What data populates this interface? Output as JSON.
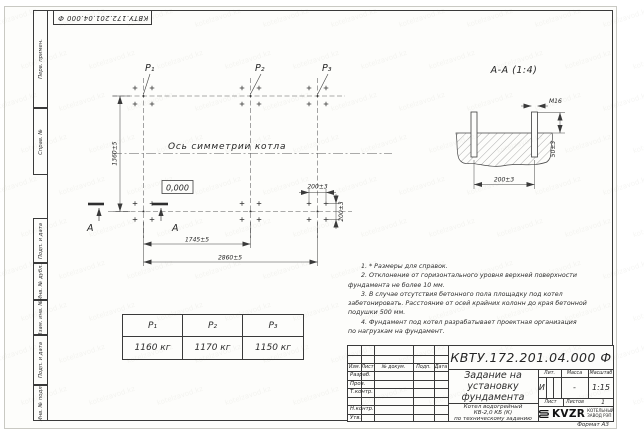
{
  "sheet": {
    "stamp_top_left": "КВТУ.172.201.04.000 Ф",
    "format_label": "Формат А3",
    "margin_fields": [
      "Перв. примен.",
      "Справ. №",
      "Подп. и дата",
      "Инв. № дубл.",
      "Взам. инв. №",
      "Подп. и дата",
      "Инв. № подл."
    ]
  },
  "watermark": {
    "text": "kotelzavod.kz"
  },
  "plan": {
    "load_labels": [
      "P₁",
      "P₂",
      "P₃"
    ],
    "axis_label": "Ось симметрии котла",
    "elevation": "0,000",
    "section_letter": "А",
    "dims": {
      "height": "1360±5",
      "span1": "1745±5",
      "span2": "2860±5",
      "bolt_h": "200±3",
      "bolt_v": "200±3"
    }
  },
  "section": {
    "title": "А-А (1:4)",
    "bolt_label": "М16",
    "dim_protrusion": "50±3",
    "dim_spacing": "200±3"
  },
  "loads_table": {
    "headers": [
      "P₁",
      "P₂",
      "P₃"
    ],
    "values": [
      "1160 кг",
      "1170 кг",
      "1150 кг"
    ]
  },
  "notes": {
    "lines": [
      "1. * Размеры для справок.",
      "2. Отклонение от горизонтального уровня верхней поверхности",
      "фундамента не более 10 мм.",
      "3. В случае отсутствия бетонного пола площадку под котел",
      "забетонировать. Расстояние от осей крайних колонн до края бетонной",
      "подушки 500 мм.",
      "4. Фундамент под котел разрабатывает проектная организация",
      "по нагрузкам на фундамент."
    ]
  },
  "title_block": {
    "doc_number": "КВТУ.172.201.04.000 Ф",
    "title_lines": [
      "Задание на",
      "установку",
      "фундамента"
    ],
    "product_lines": [
      "Котел водогрейный",
      "КВ-2,0 КБ (К)",
      "по техническому заданию"
    ],
    "header_cols": [
      "Изм.",
      "Лист",
      "№ докум.",
      "Подп.",
      "Дата"
    ],
    "sign_rows": [
      "Разраб.",
      "Пров.",
      "Т.контр.",
      "",
      "Н.контр.",
      "Утв."
    ],
    "lit_label": "Лит.",
    "lit_value": "И",
    "mass_label": "Масса",
    "mass_value": "-",
    "scale_label": "Масштаб",
    "scale_value": "1:15",
    "sheet_label": "Лист",
    "sheets_label": "Листов",
    "sheets_value": "1",
    "logo_text": "KVZR",
    "logo_sub1": "КОТЕЛЬНЫЙ",
    "logo_sub2": "ЗАВОД РЭП"
  }
}
